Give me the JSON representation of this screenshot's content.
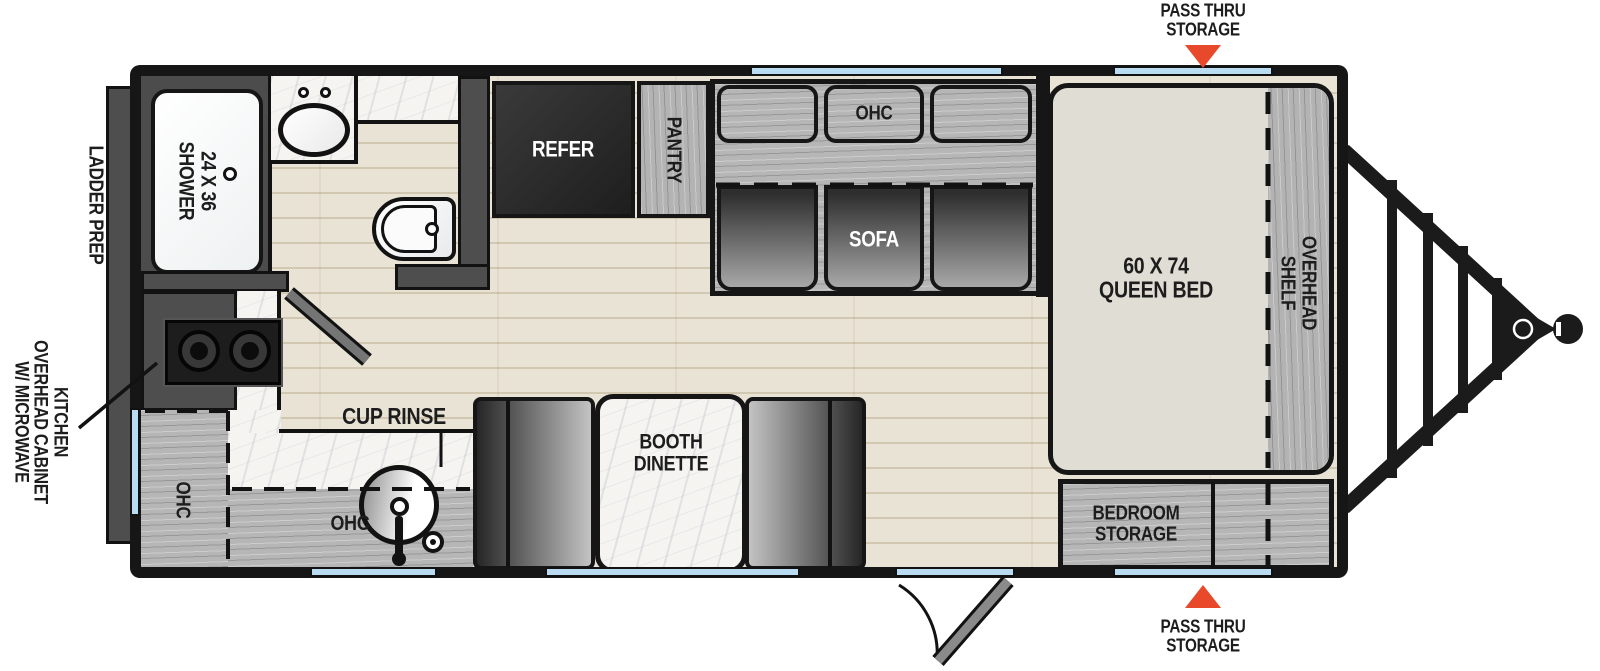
{
  "colors": {
    "accent_red": "#E8492B",
    "window_blue": "#B9DCF2",
    "wall_black": "#161616",
    "cabinet_gray": "#B5B5B5",
    "floor_wood": "#E8E2D4"
  },
  "exterior_labels": {
    "pass_thru_top": {
      "line1": "PASS THRU",
      "line2": "STORAGE"
    },
    "pass_thru_bottom": {
      "line1": "PASS THRU",
      "line2": "STORAGE"
    },
    "ladder_prep": "LADDER PREP",
    "kitchen_cabinet": {
      "line1": "KITCHEN",
      "line2": "OVERHEAD CABINET",
      "line3": "W/ MICROWAVE"
    }
  },
  "bathroom": {
    "shower": {
      "line1": "24 X 36",
      "line2": "SHOWER"
    }
  },
  "kitchen": {
    "cup_rinse": "CUP RINSE",
    "ohc_side": "OHC",
    "ohc_lower": "OHC"
  },
  "living_area": {
    "refer": "REFER",
    "pantry": "PANTRY",
    "sofa_ohc": "OHC",
    "sofa": "SOFA",
    "dinette": {
      "line1": "BOOTH",
      "line2": "DINETTE"
    }
  },
  "bedroom": {
    "bed": {
      "line1": "60 X 74",
      "line2": "QUEEN BED"
    },
    "overhead_shelf": {
      "line1": "OVERHEAD",
      "line2": "SHELF"
    },
    "storage": {
      "line1": "BEDROOM",
      "line2": "STORAGE"
    }
  }
}
